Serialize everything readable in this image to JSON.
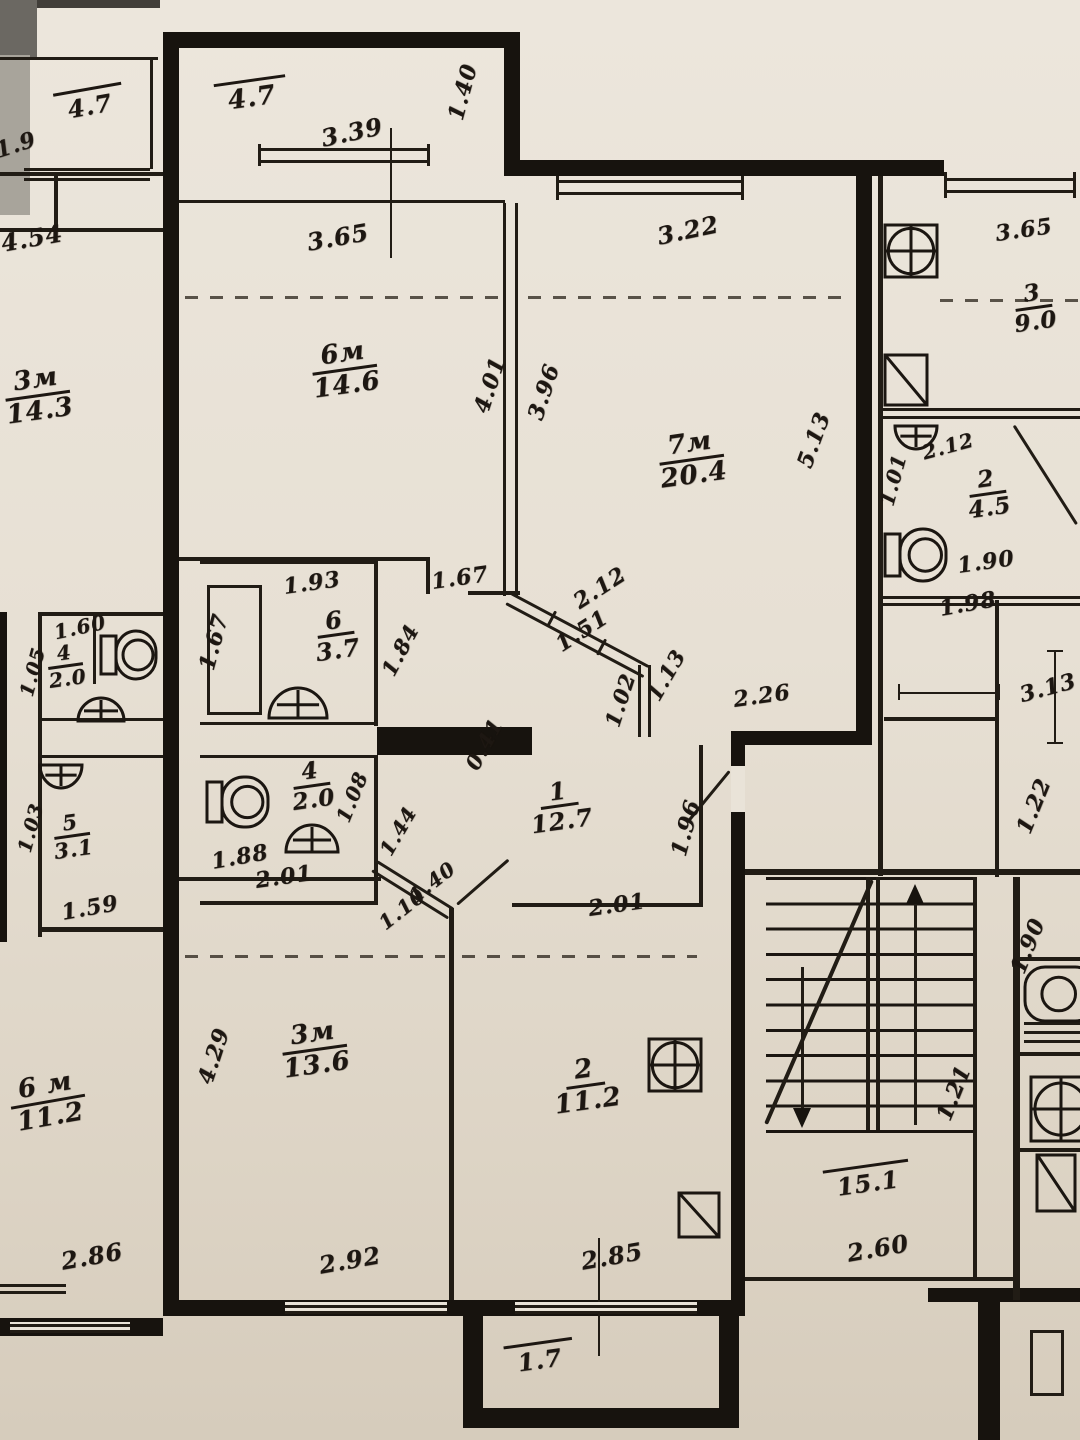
{
  "document": {
    "kind": "scanned apartment floor plan (BTI blueprint photo)",
    "units": "meters",
    "style": "hand-inked plan with cursive dimension figures"
  },
  "apartment_main": {
    "rooms": [
      {
        "number": "6м",
        "area_m2": "14.6",
        "type": "living-room"
      },
      {
        "number": "7м",
        "area_m2": "20.4",
        "type": "living-room"
      },
      {
        "number": "1",
        "area_m2": "12.7",
        "type": "hallway"
      },
      {
        "number": "6",
        "area_m2": "3.7",
        "type": "bathroom"
      },
      {
        "number": "4",
        "area_m2": "2.0",
        "type": "wc"
      },
      {
        "number": "3м",
        "area_m2": "13.6",
        "type": "living-room"
      },
      {
        "number": "2",
        "area_m2": "11.2",
        "type": "kitchen"
      }
    ],
    "balcony_top_area": "4.7",
    "balcony_bottom_area": "1.7"
  },
  "stairwell": {
    "area_m2": "15.1",
    "width_dim": "2.60"
  },
  "apartment_right": {
    "rooms": [
      {
        "number": "3",
        "area_m2": "9.0",
        "type": "kitchen"
      },
      {
        "number": "2",
        "area_m2": "4.5",
        "type": "bathroom"
      }
    ]
  },
  "apartment_left": {
    "rooms": [
      {
        "number": "3м",
        "area_m2": "14.3",
        "type": "living-room"
      },
      {
        "number": "4",
        "area_m2": "2.0",
        "type": "wc"
      },
      {
        "number": "5",
        "area_m2": "3.1",
        "type": "bathroom"
      },
      {
        "number": "6 м",
        "area_m2": "11.2",
        "type": "living-room"
      }
    ],
    "balcony_area": "4.7"
  },
  "labels": [
    {
      "k": "o",
      "t": "4.7",
      "x": 252,
      "y": 98,
      "r": -8,
      "s": 26
    },
    {
      "k": "d",
      "t": "3.39",
      "x": 352,
      "y": 132,
      "r": -12,
      "s": 24
    },
    {
      "k": "d",
      "t": "1.40",
      "x": 463,
      "y": 92,
      "r": -75,
      "s": 22
    },
    {
      "k": "d",
      "t": "3.65",
      "x": 338,
      "y": 237,
      "r": -10,
      "s": 24
    },
    {
      "k": "d",
      "t": "3.22",
      "x": 688,
      "y": 230,
      "r": -12,
      "s": 24
    },
    {
      "k": "f",
      "t": "6м",
      "b": "14.6",
      "x": 345,
      "y": 370,
      "r": -8,
      "s": 26
    },
    {
      "k": "f",
      "t": "7м",
      "b": "20.4",
      "x": 692,
      "y": 460,
      "r": -8,
      "s": 26
    },
    {
      "k": "d",
      "t": "4.01",
      "x": 490,
      "y": 385,
      "r": -72,
      "s": 22
    },
    {
      "k": "d",
      "t": "3.96",
      "x": 544,
      "y": 392,
      "r": -72,
      "s": 22
    },
    {
      "k": "d",
      "t": "5.13",
      "x": 814,
      "y": 440,
      "r": -70,
      "s": 22
    },
    {
      "k": "d",
      "t": "1.93",
      "x": 312,
      "y": 583,
      "r": -8,
      "s": 22
    },
    {
      "k": "d",
      "t": "1.67",
      "x": 214,
      "y": 642,
      "r": -75,
      "s": 22
    },
    {
      "k": "f",
      "t": "6",
      "b": "3.7",
      "x": 336,
      "y": 635,
      "r": -8,
      "s": 24
    },
    {
      "k": "d",
      "t": "1.84",
      "x": 400,
      "y": 650,
      "r": -62,
      "s": 21
    },
    {
      "k": "d",
      "t": "1.67",
      "x": 460,
      "y": 578,
      "r": -8,
      "s": 22
    },
    {
      "k": "d",
      "t": "2.12",
      "x": 600,
      "y": 588,
      "r": -33,
      "s": 22
    },
    {
      "k": "d",
      "t": "1.51",
      "x": 582,
      "y": 631,
      "r": -33,
      "s": 22
    },
    {
      "k": "d",
      "t": "1.13",
      "x": 666,
      "y": 675,
      "r": -60,
      "s": 21
    },
    {
      "k": "d",
      "t": "1.02",
      "x": 620,
      "y": 700,
      "r": -72,
      "s": 21
    },
    {
      "k": "d",
      "t": "2.26",
      "x": 762,
      "y": 696,
      "r": -8,
      "s": 22
    },
    {
      "k": "d",
      "t": "0.41",
      "x": 484,
      "y": 744,
      "r": -62,
      "s": 21
    },
    {
      "k": "f",
      "t": "1",
      "b": "12.7",
      "x": 560,
      "y": 806,
      "r": -8,
      "s": 24
    },
    {
      "k": "d",
      "t": "1.96",
      "x": 686,
      "y": 828,
      "r": -75,
      "s": 22
    },
    {
      "k": "f",
      "t": "4",
      "b": "2.0",
      "x": 312,
      "y": 786,
      "r": -8,
      "s": 23
    },
    {
      "k": "d",
      "t": "1.88",
      "x": 240,
      "y": 857,
      "r": -10,
      "s": 22
    },
    {
      "k": "d",
      "t": "1.08",
      "x": 352,
      "y": 797,
      "r": -68,
      "s": 20
    },
    {
      "k": "d",
      "t": "1.44",
      "x": 398,
      "y": 831,
      "r": -60,
      "s": 20
    },
    {
      "k": "d",
      "t": "2.01",
      "x": 284,
      "y": 877,
      "r": -8,
      "s": 22
    },
    {
      "k": "d",
      "t": "2.01",
      "x": 617,
      "y": 905,
      "r": -8,
      "s": 22
    },
    {
      "k": "d",
      "t": "1.40",
      "x": 432,
      "y": 882,
      "r": -38,
      "s": 20
    },
    {
      "k": "d",
      "t": "1.10",
      "x": 402,
      "y": 909,
      "r": -38,
      "s": 20
    },
    {
      "k": "f",
      "t": "3м",
      "b": "13.6",
      "x": 315,
      "y": 1050,
      "r": -8,
      "s": 26
    },
    {
      "k": "d",
      "t": "4.29",
      "x": 214,
      "y": 1056,
      "r": -72,
      "s": 22
    },
    {
      "k": "d",
      "t": "2.92",
      "x": 350,
      "y": 1260,
      "r": -10,
      "s": 24
    },
    {
      "k": "f",
      "t": "2",
      "b": "11.2",
      "x": 586,
      "y": 1086,
      "r": -8,
      "s": 26
    },
    {
      "k": "d",
      "t": "2.85",
      "x": 612,
      "y": 1256,
      "r": -10,
      "s": 24
    },
    {
      "k": "o",
      "t": "1.7",
      "x": 540,
      "y": 1360,
      "r": -8,
      "s": 24
    },
    {
      "k": "o",
      "t": "15.1",
      "x": 868,
      "y": 1183,
      "r": -8,
      "s": 24
    },
    {
      "k": "d",
      "t": "2.60",
      "x": 878,
      "y": 1248,
      "r": -10,
      "s": 24
    },
    {
      "k": "d",
      "t": "1.21",
      "x": 954,
      "y": 1093,
      "r": -68,
      "s": 22
    },
    {
      "k": "d",
      "t": "3.65",
      "x": 1024,
      "y": 230,
      "r": -8,
      "s": 22
    },
    {
      "k": "f",
      "t": "3",
      "b": "9.0",
      "x": 1034,
      "y": 308,
      "r": -8,
      "s": 23
    },
    {
      "k": "d",
      "t": "2.12",
      "x": 948,
      "y": 446,
      "r": -15,
      "s": 20
    },
    {
      "k": "f",
      "t": "2",
      "b": "4.5",
      "x": 988,
      "y": 494,
      "r": -8,
      "s": 23
    },
    {
      "k": "d",
      "t": "1.90",
      "x": 986,
      "y": 562,
      "r": -8,
      "s": 22
    },
    {
      "k": "d",
      "t": "1.98",
      "x": 968,
      "y": 604,
      "r": -10,
      "s": 22
    },
    {
      "k": "d",
      "t": "1.01",
      "x": 893,
      "y": 480,
      "r": -75,
      "s": 20
    },
    {
      "k": "d",
      "t": "3.13",
      "x": 1048,
      "y": 688,
      "r": -15,
      "s": 22
    },
    {
      "k": "d",
      "t": "1.22",
      "x": 1034,
      "y": 806,
      "r": -68,
      "s": 22
    },
    {
      "k": "d",
      "t": "1.90",
      "x": 1028,
      "y": 946,
      "r": -68,
      "s": 22
    },
    {
      "k": "o",
      "t": "4.7",
      "x": 90,
      "y": 106,
      "r": -10,
      "s": 24
    },
    {
      "k": "d",
      "t": "1.9",
      "x": 16,
      "y": 145,
      "r": -18,
      "s": 22
    },
    {
      "k": "d",
      "t": "4.54",
      "x": 32,
      "y": 238,
      "r": -10,
      "s": 24
    },
    {
      "k": "f",
      "t": "3м",
      "b": "14.3",
      "x": 38,
      "y": 396,
      "r": -8,
      "s": 26
    },
    {
      "k": "d",
      "t": "1.60",
      "x": 80,
      "y": 627,
      "r": -12,
      "s": 20
    },
    {
      "k": "f",
      "t": "4",
      "b": "2.0",
      "x": 66,
      "y": 666,
      "r": -8,
      "s": 20
    },
    {
      "k": "d",
      "t": "1.05",
      "x": 33,
      "y": 672,
      "r": -75,
      "s": 19
    },
    {
      "k": "f",
      "t": "5",
      "b": "3.1",
      "x": 72,
      "y": 836,
      "r": -8,
      "s": 21
    },
    {
      "k": "d",
      "t": "1.03",
      "x": 31,
      "y": 828,
      "r": -75,
      "s": 19
    },
    {
      "k": "d",
      "t": "1.59",
      "x": 90,
      "y": 908,
      "r": -10,
      "s": 22
    },
    {
      "k": "f",
      "t": "6 м",
      "b": "11.2",
      "x": 48,
      "y": 1102,
      "r": -10,
      "s": 26
    },
    {
      "k": "d",
      "t": "2.86",
      "x": 92,
      "y": 1256,
      "r": -10,
      "s": 24
    }
  ],
  "icons": [
    {
      "name": "sink-icon",
      "type": "sink",
      "x": 267,
      "y": 686,
      "w": 62,
      "h": 34,
      "rot": 0
    },
    {
      "name": "sink-icon",
      "type": "sink",
      "x": 284,
      "y": 823,
      "w": 56,
      "h": 31,
      "rot": 0
    },
    {
      "name": "toilet-icon",
      "type": "toilet",
      "x": 206,
      "y": 776,
      "w": 64,
      "h": 52,
      "rot": 0
    },
    {
      "name": "stove-icon",
      "type": "stove",
      "x": 648,
      "y": 1038,
      "w": 54,
      "h": 54,
      "rot": 0
    },
    {
      "name": "fridge-icon",
      "type": "fridge",
      "x": 678,
      "y": 1192,
      "w": 42,
      "h": 46,
      "rot": 0
    },
    {
      "name": "stove-icon",
      "type": "stove",
      "x": 884,
      "y": 224,
      "w": 54,
      "h": 54,
      "rot": 0
    },
    {
      "name": "fridge-icon",
      "type": "fridge",
      "x": 884,
      "y": 354,
      "w": 44,
      "h": 52,
      "rot": 0
    },
    {
      "name": "sink-icon",
      "type": "sink",
      "x": 893,
      "y": 424,
      "w": 46,
      "h": 27,
      "rot": 180
    },
    {
      "name": "toilet-icon",
      "type": "toilet",
      "x": 884,
      "y": 528,
      "w": 64,
      "h": 54,
      "rot": 0
    },
    {
      "name": "toilet-icon",
      "type": "toilet",
      "x": 100,
      "y": 630,
      "w": 58,
      "h": 50,
      "rot": 0
    },
    {
      "name": "sink-icon",
      "type": "sink",
      "x": 76,
      "y": 696,
      "w": 50,
      "h": 27,
      "rot": 0
    },
    {
      "name": "sink-icon",
      "type": "sink",
      "x": 38,
      "y": 763,
      "w": 46,
      "h": 27,
      "rot": 180
    },
    {
      "name": "tub-icon",
      "type": "tub",
      "x": 1024,
      "y": 966,
      "w": 56,
      "h": 56,
      "rot": 0
    },
    {
      "name": "stove-icon",
      "type": "stove",
      "x": 1030,
      "y": 1076,
      "w": 62,
      "h": 66,
      "rot": 0
    },
    {
      "name": "fridge-icon",
      "type": "fridge",
      "x": 1036,
      "y": 1154,
      "w": 40,
      "h": 58,
      "rot": 0
    }
  ]
}
